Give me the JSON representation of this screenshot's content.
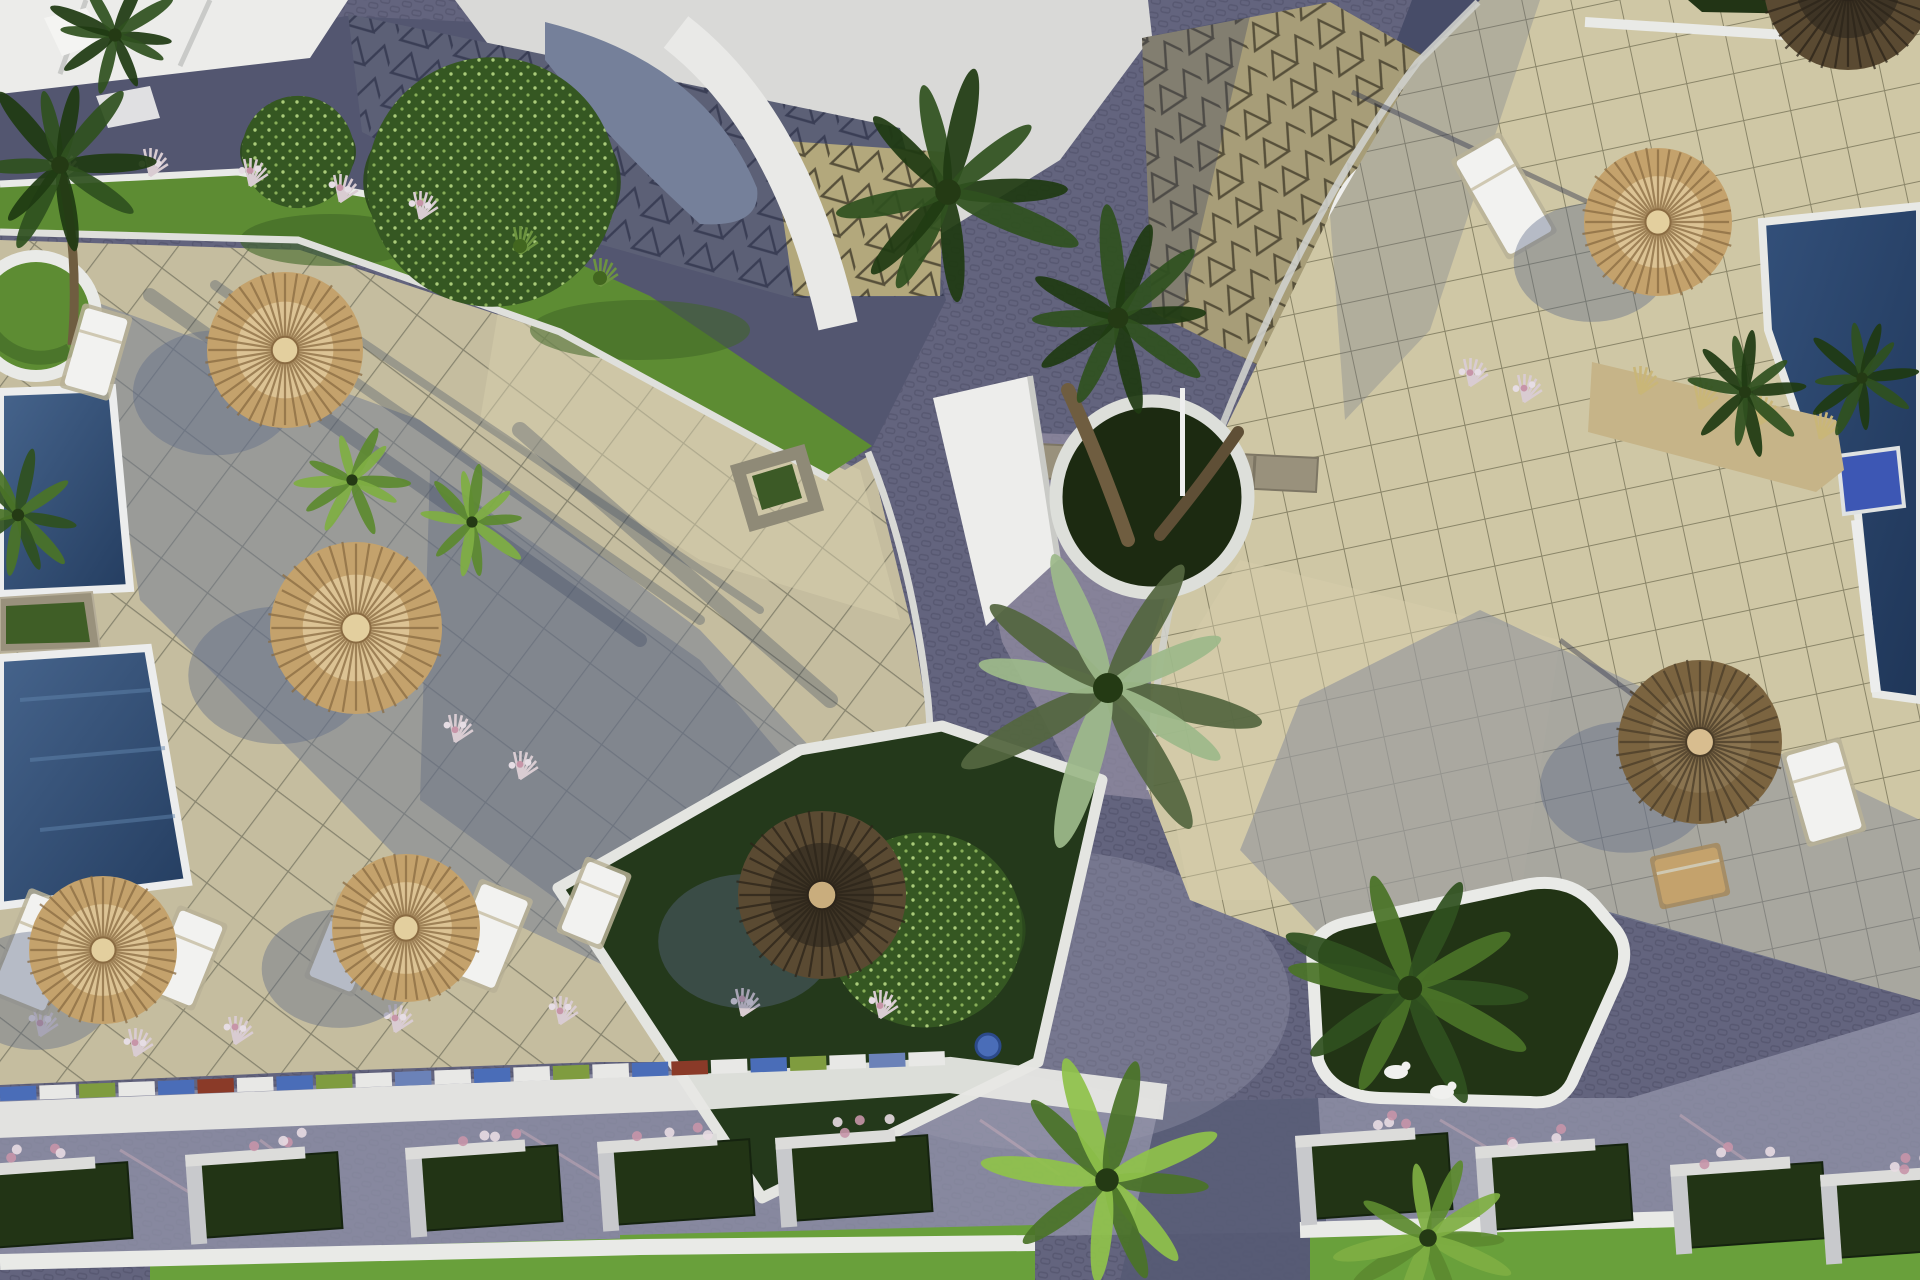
{
  "scene": {
    "description": "Aerial 3D architectural render of a resort courtyard with beige tiled terraces, purple cobblestone paths, swimming pools, straw parasols, sun loungers, palm trees and white-curbed planters",
    "render_style": "daytime, hard sun from upper right, long blue shadows to lower-left"
  },
  "palette": {
    "cobble": "#63647e",
    "road_dark": "#535670",
    "road_darker": "#474c68",
    "road_lavender": "#8f90a6",
    "road_light": "#9a9bb0",
    "apron": "#8f8aa0",
    "curb": "#e9eae7",
    "wall_white": "#f1f1ef",
    "sky": "#d9d9d7",
    "tri_sun": "#b3a87c",
    "tri_dark": "#5c6076",
    "tri_line": "#57503a",
    "tri_line_dark": "#434760",
    "plaza": "#c5bd9f",
    "terrace": "#cfc7a5",
    "sun_patch": "#d8cfad",
    "shadow": "#5c6886",
    "pool_deep": "#243c5e",
    "pool_mid": "#40608a",
    "pool_step": "#3d57b4",
    "grass": "#5d8c33",
    "grass_bright": "#69a03b",
    "grass_dark": "#3f6626",
    "planter_dark": "#223415",
    "stone": "#99917c",
    "trunk": "#6f5d40",
    "palm_dark": "#2f511f",
    "palm_mid": "#4a7328",
    "palm_light": "#7fae43",
    "palm_silver": "#9db98a",
    "tree_green": "#355722",
    "tree_speckle": "#bfe08a",
    "straw": "#c4a26c",
    "straw_light": "#dcc394",
    "straw_dark": "#8a6b42",
    "umb_dark": "#3e3425",
    "umb_fringe": "#7b6440",
    "pink": "#c795a8",
    "sand": "#c6b488",
    "pad": "#f2f2f0"
  },
  "objects": {
    "umbrellas": [
      {
        "x": 285,
        "y": 350,
        "r": 78,
        "variant": "tan",
        "shadow": true
      },
      {
        "x": 356,
        "y": 628,
        "r": 86,
        "variant": "tan",
        "shadow": true
      },
      {
        "x": 103,
        "y": 950,
        "r": 74,
        "variant": "tan",
        "shadow": true
      },
      {
        "x": 406,
        "y": 928,
        "r": 74,
        "variant": "tan",
        "shadow": true
      },
      {
        "x": 822,
        "y": 895,
        "r": 84,
        "variant": "dark",
        "shadow": true
      },
      {
        "x": 1658,
        "y": 222,
        "r": 74,
        "variant": "tan",
        "shadow": true
      },
      {
        "x": 1700,
        "y": 742,
        "r": 82,
        "variant": "fringe",
        "shadow": true
      },
      {
        "x": 1848,
        "y": -14,
        "r": 84,
        "variant": "dark",
        "shadow": false
      }
    ],
    "loungers": [
      {
        "x": 38,
        "y": 952,
        "w": 56,
        "h": 106,
        "rot": 22,
        "tone": "white"
      },
      {
        "x": 186,
        "y": 958,
        "w": 46,
        "h": 86,
        "rot": 22,
        "tone": "white"
      },
      {
        "x": 346,
        "y": 944,
        "w": 46,
        "h": 86,
        "rot": 22,
        "tone": "white"
      },
      {
        "x": 488,
        "y": 936,
        "w": 50,
        "h": 94,
        "rot": 22,
        "tone": "white"
      },
      {
        "x": 594,
        "y": 903,
        "w": 42,
        "h": 74,
        "rot": 22,
        "tone": "white"
      },
      {
        "x": 96,
        "y": 352,
        "w": 44,
        "h": 80,
        "rot": 16,
        "tone": "white"
      },
      {
        "x": 1504,
        "y": 196,
        "w": 50,
        "h": 108,
        "rot": -30,
        "tone": "white"
      },
      {
        "x": 1690,
        "y": 876,
        "w": 64,
        "h": 46,
        "rot": -12,
        "tone": "tan"
      },
      {
        "x": 1824,
        "y": 792,
        "w": 54,
        "h": 90,
        "rot": -16,
        "tone": "white"
      }
    ],
    "palms": [
      {
        "x": 60,
        "y": 165,
        "r": 88,
        "tone": "dark",
        "trunk": [
          72,
          345
        ]
      },
      {
        "x": 18,
        "y": 515,
        "r": 62,
        "tone": "mid"
      },
      {
        "x": 115,
        "y": 35,
        "r": 66,
        "tone": "dark"
      },
      {
        "x": 352,
        "y": 480,
        "r": 56,
        "tone": "light"
      },
      {
        "x": 472,
        "y": 522,
        "r": 56,
        "tone": "light"
      },
      {
        "x": 948,
        "y": 192,
        "r": 128,
        "tone": "dark"
      },
      {
        "x": 1118,
        "y": 318,
        "r": 104,
        "tone": "dark"
      },
      {
        "x": 1745,
        "y": 392,
        "r": 60,
        "tone": "dark"
      },
      {
        "x": 1862,
        "y": 378,
        "r": 56,
        "tone": "dark"
      },
      {
        "x": 1410,
        "y": 988,
        "r": 122,
        "tone": "mid"
      }
    ],
    "foreground_palms": [
      {
        "x": 1108,
        "y": 688,
        "r": 150,
        "tone": "silver"
      },
      {
        "x": 1107,
        "y": 1180,
        "r": 118,
        "tone": "bright"
      },
      {
        "x": 1428,
        "y": 1238,
        "r": 88,
        "tone": "light"
      }
    ],
    "trees": [
      {
        "x": 492,
        "y": 182,
        "r": 160
      },
      {
        "x": 298,
        "y": 152,
        "r": 72
      },
      {
        "x": 925,
        "y": 930,
        "r": 125
      }
    ],
    "tufts": [
      {
        "x": 60,
        "y": 175,
        "v": "pink"
      },
      {
        "x": 150,
        "y": 172,
        "v": "pink"
      },
      {
        "x": 250,
        "y": 182,
        "v": "pink"
      },
      {
        "x": 340,
        "y": 198,
        "v": "pink"
      },
      {
        "x": 420,
        "y": 215,
        "v": "pink"
      },
      {
        "x": 520,
        "y": 250,
        "v": "green"
      },
      {
        "x": 600,
        "y": 282,
        "v": "green"
      },
      {
        "x": 455,
        "y": 738,
        "v": "pinkwhite"
      },
      {
        "x": 520,
        "y": 775,
        "v": "pinkwhite"
      },
      {
        "x": 1640,
        "y": 390,
        "v": "dry"
      },
      {
        "x": 1700,
        "y": 405,
        "v": "dry"
      },
      {
        "x": 1760,
        "y": 420,
        "v": "dry"
      },
      {
        "x": 1820,
        "y": 435,
        "v": "dry"
      },
      {
        "x": 1470,
        "y": 382,
        "v": "pink"
      },
      {
        "x": 1524,
        "y": 398,
        "v": "pink"
      },
      {
        "x": 40,
        "y": 1032,
        "v": "pinkwhite"
      },
      {
        "x": 135,
        "y": 1052,
        "v": "pinkwhite"
      },
      {
        "x": 235,
        "y": 1040,
        "v": "pinkwhite"
      },
      {
        "x": 395,
        "y": 1028,
        "v": "pinkwhite"
      },
      {
        "x": 560,
        "y": 1020,
        "v": "pinkwhite"
      },
      {
        "x": 742,
        "y": 1012,
        "v": "pinkwhite"
      },
      {
        "x": 880,
        "y": 1014,
        "v": "pinkwhite"
      }
    ],
    "planter_boxes": [
      {
        "x": 60,
        "y": 1205
      },
      {
        "x": 270,
        "y": 1195
      },
      {
        "x": 490,
        "y": 1188
      },
      {
        "x": 682,
        "y": 1182
      },
      {
        "x": 860,
        "y": 1178
      },
      {
        "x": 1380,
        "y": 1176
      },
      {
        "x": 1560,
        "y": 1187
      },
      {
        "x": 1755,
        "y": 1205
      },
      {
        "x": 1905,
        "y": 1215
      }
    ],
    "statues": [
      {
        "x": 1396,
        "y": 1072
      },
      {
        "x": 1442,
        "y": 1092
      }
    ],
    "curb_strip": {
      "x1": 0,
      "y1": 1094,
      "x2": 948,
      "y2": 1058,
      "segments": 24,
      "colors": [
        "#4a6db8",
        "#e8e8e6",
        "#7f9c3f",
        "#e8e8e6",
        "#4a6db8",
        "#8a3a28",
        "#e8e8e6",
        "#4a6db8",
        "#7f9c3f",
        "#e8e8e6",
        "#6b82b8",
        "#e8e8e6"
      ]
    }
  }
}
